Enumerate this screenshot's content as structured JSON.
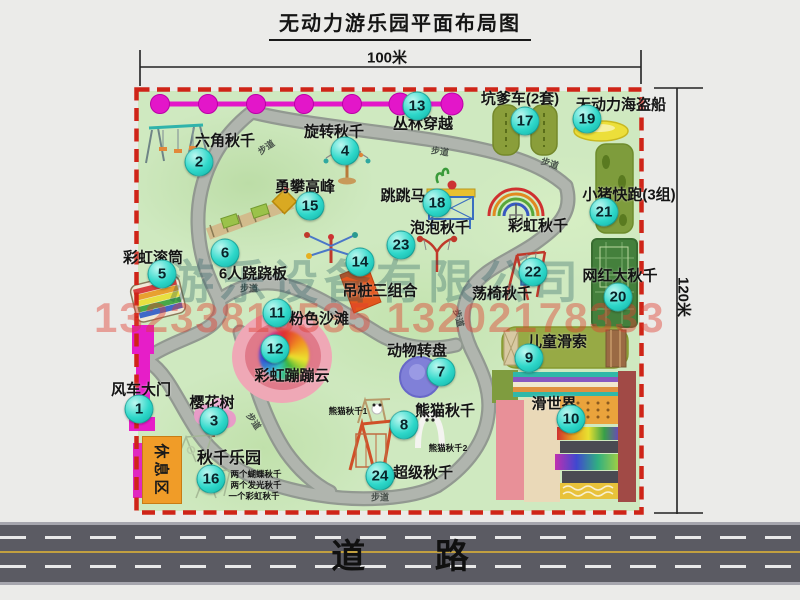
{
  "title": "无动力游乐园平面布局图",
  "dimensions": {
    "width": "100米",
    "height": "120米"
  },
  "road": {
    "label": "道 路"
  },
  "walkway_label": "步道",
  "watermark": {
    "company": "游乐设备有限公司",
    "phone": "13233816535 13202178333"
  },
  "colors": {
    "park-green": "#cfe9c0",
    "border-red": "#cf2418",
    "badge-teal": "#2fd8ca",
    "gate-magenta": "#e61ec8",
    "chain-magenta": "#e316c9",
    "path-gray": "#a6aba5",
    "road-gray": "#5b5b63"
  },
  "items": {
    "windmill_gate": {
      "num": "1",
      "label": "风车大门"
    },
    "hex_swing": {
      "num": "2",
      "label": "六角秋千"
    },
    "cherry_tree": {
      "num": "3",
      "label": "樱花树"
    },
    "rotary_swing": {
      "num": "4",
      "label": "旋转秋千"
    },
    "rainbow_roller": {
      "num": "5",
      "label": "彩虹滚筒"
    },
    "six_seesaw": {
      "num": "6",
      "label": "6人跷跷板"
    },
    "animal_turntable": {
      "num": "7",
      "label": "动物转盘"
    },
    "panda_swing": {
      "num": "8",
      "label": "熊猫秋千",
      "sub1": "熊猫秋千1",
      "sub2": "熊猫秋千2"
    },
    "kids_zipline": {
      "num": "9",
      "label": "儿童滑索"
    },
    "slide_world": {
      "num": "10",
      "label": "滑世界"
    },
    "pink_beach": {
      "num": "11",
      "label": "粉色沙滩"
    },
    "rainbow_cloud": {
      "num": "12",
      "label": "彩虹蹦蹦云"
    },
    "jungle_crossing": {
      "num": "13",
      "label": "丛林穿越"
    },
    "hanging_piles": {
      "num": "14",
      "label": "吊桩三组合"
    },
    "peak_climb": {
      "num": "15",
      "label": "勇攀高峰"
    },
    "swing_park": {
      "num": "16",
      "label": "秋千乐园",
      "notes": [
        "两个蝴蝶秋千",
        "两个发光秋千",
        "一个彩虹秋千"
      ]
    },
    "pit_cars": {
      "num": "17",
      "label": "坑爹车(2套)"
    },
    "jump_horse": {
      "num": "18",
      "label": "跳跳马"
    },
    "pirate_ship": {
      "num": "19",
      "label": "无动力海盗船"
    },
    "big_swing": {
      "num": "20",
      "label": "网红大秋千"
    },
    "piggy_run": {
      "num": "21",
      "label": "小猪快跑(3组)"
    },
    "chair_swing": {
      "num": "22",
      "label": "荡椅秋千"
    },
    "bubble_swing": {
      "num": "23",
      "label": "泡泡秋千"
    },
    "super_swing": {
      "num": "24",
      "label": "超级秋千"
    },
    "rainbow_swing": {
      "label": "彩虹秋千"
    },
    "rest_area": {
      "label": "休息区"
    }
  }
}
